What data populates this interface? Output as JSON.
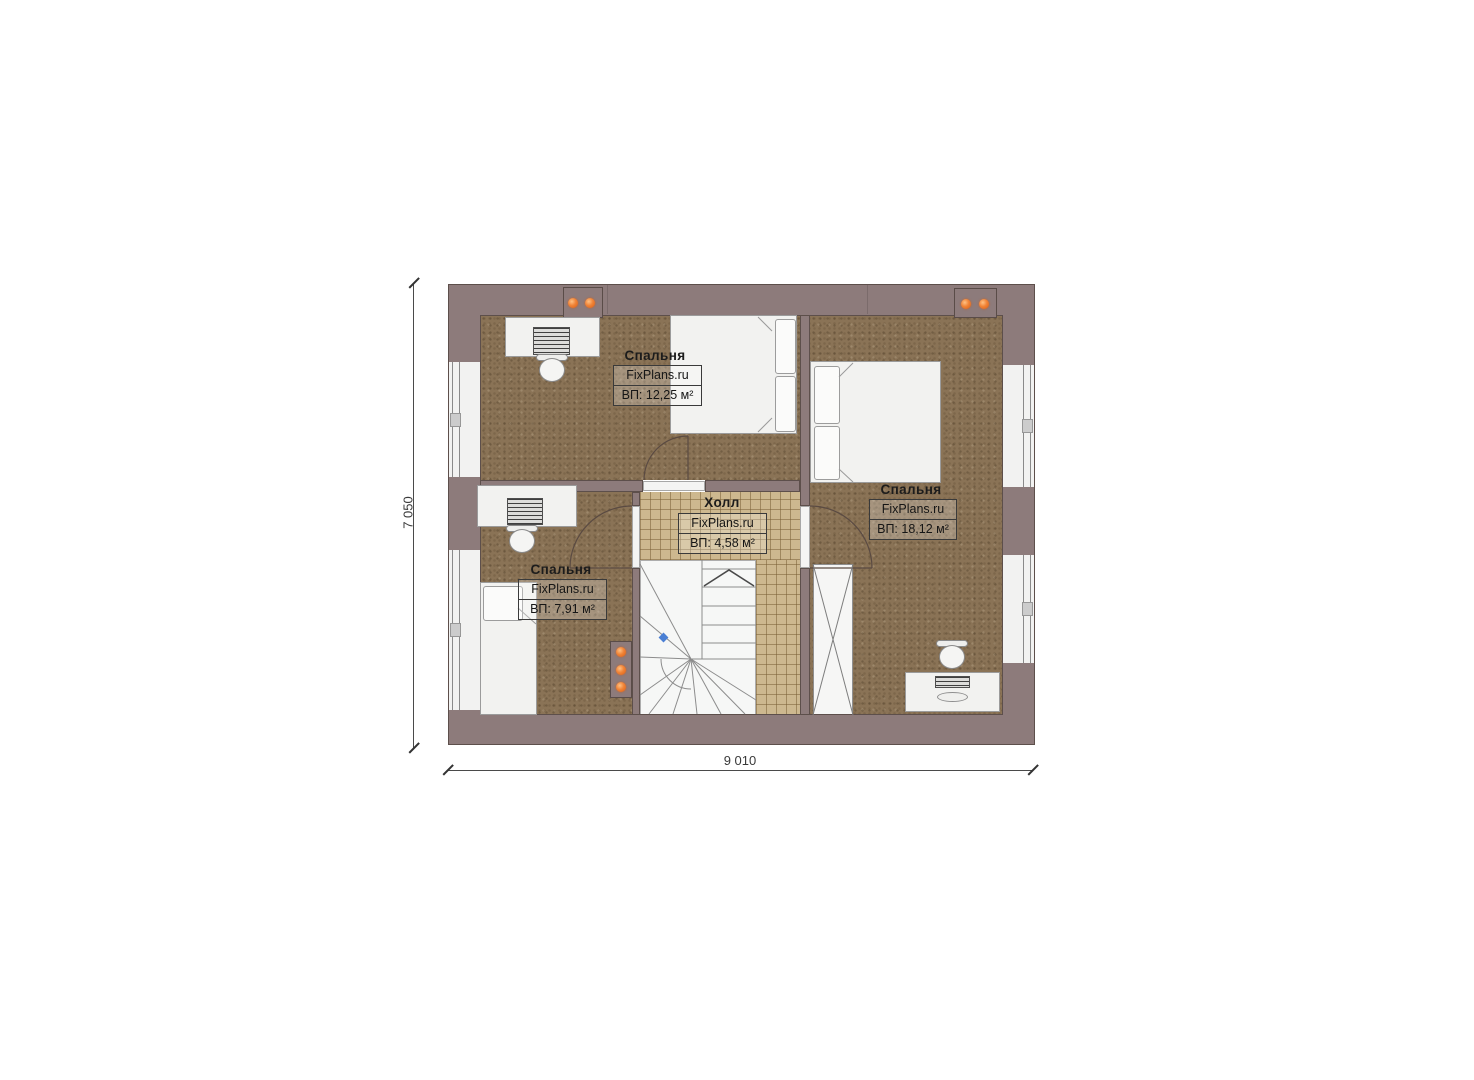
{
  "plan": {
    "type": "floor-plan",
    "rooms": [
      {
        "id": "bedroom-top-left",
        "name": "Спальня",
        "brand": "FixPlans.ru",
        "area": "ВП: 12,25 м²"
      },
      {
        "id": "bedroom-right",
        "name": "Спальня",
        "brand": "FixPlans.ru",
        "area": "ВП: 18,12 м²"
      },
      {
        "id": "hall",
        "name": "Холл",
        "brand": "FixPlans.ru",
        "area": "ВП: 4,58 м²"
      },
      {
        "id": "bedroom-bottom-left",
        "name": "Спальня",
        "brand": "FixPlans.ru",
        "area": "ВП: 7,91 м²"
      }
    ],
    "dimensions": {
      "height_label": "7 050",
      "width_label": "9 010"
    },
    "colors": {
      "wall": "#8d7b7b",
      "wall_outline": "#5d4f4b",
      "carpet": "#8a7356",
      "tile": "#cdb88f",
      "stair": "#f6f7f6",
      "vent_dot": "#e2621b",
      "level_marker": "#4a7fd4",
      "dim_text": "#3a3a3a"
    }
  }
}
